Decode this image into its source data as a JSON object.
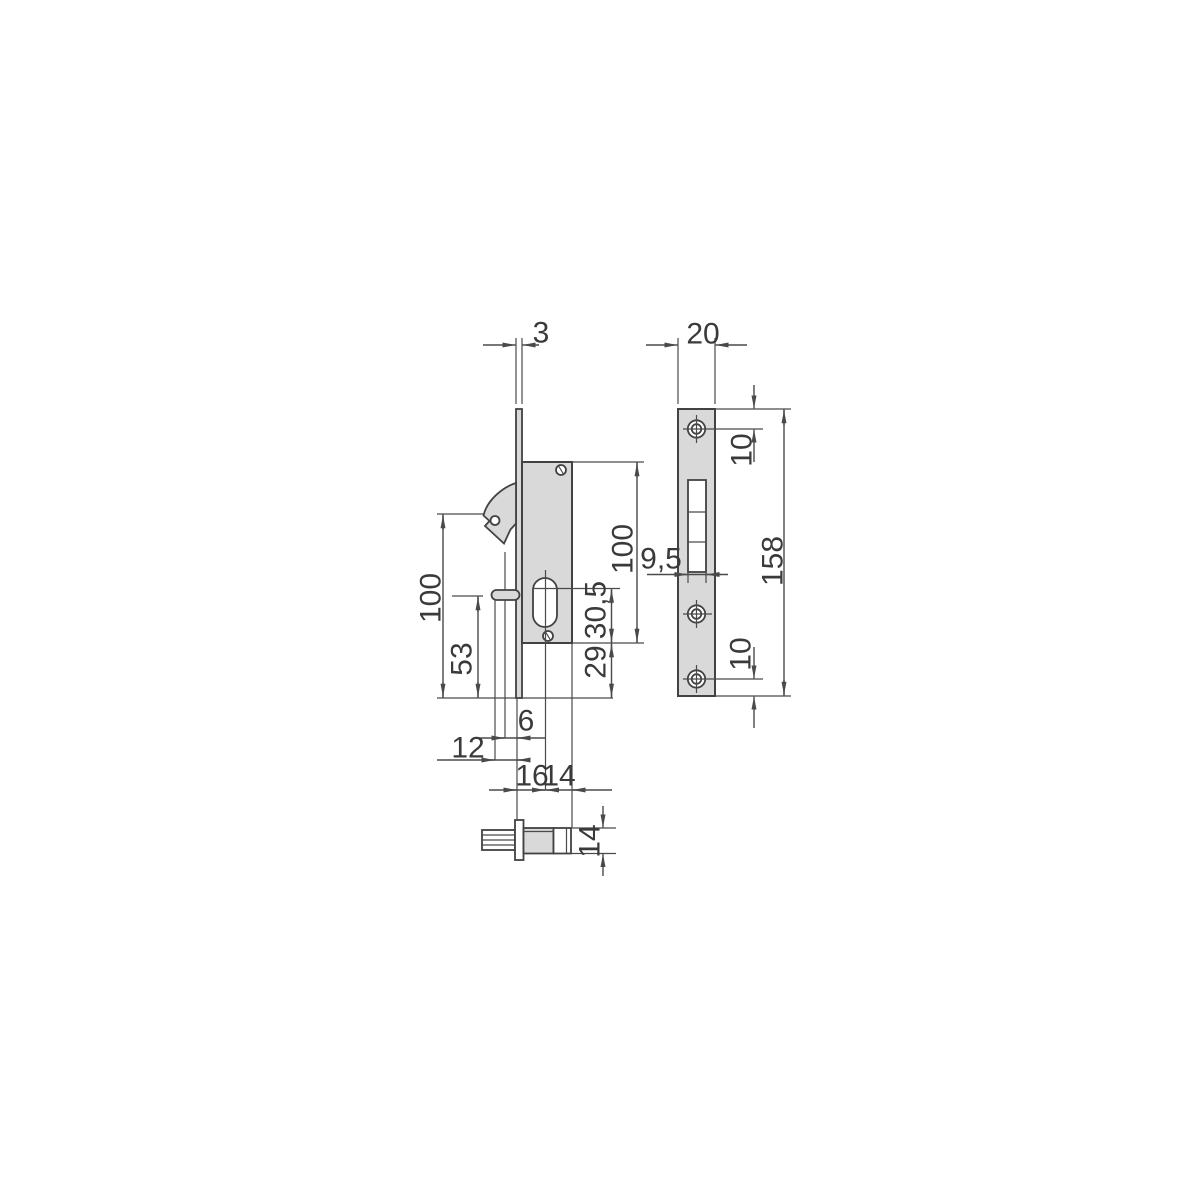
{
  "drawing": {
    "type": "technical-dimension-drawing",
    "subject": "hook-bolt mortise lock: side view with faceplate, strike plate front view, follower detail",
    "colors": {
      "part_fill": "#d9d9d9",
      "line": "#424242",
      "label": "#3a3a3a",
      "background": "#ffffff"
    },
    "labels": {
      "faceplate_thickness": "3",
      "strike_plate_width": "20",
      "strike_hole_top_offset": "10",
      "strike_plate_height": "158",
      "strike_slot_width": "9,5",
      "strike_hole_bottom_offset": "10",
      "hook_pivot_height": "100",
      "pin_height": "53",
      "body_height": "100",
      "cylinder_center_to_bottom": "30,5",
      "body_bottom_to_baseline": "29",
      "hook_protrusion": "6",
      "pin_protrusion": "12",
      "cylinder_backset": "16",
      "cylinder_to_back": "14",
      "follower_height": "14"
    }
  }
}
